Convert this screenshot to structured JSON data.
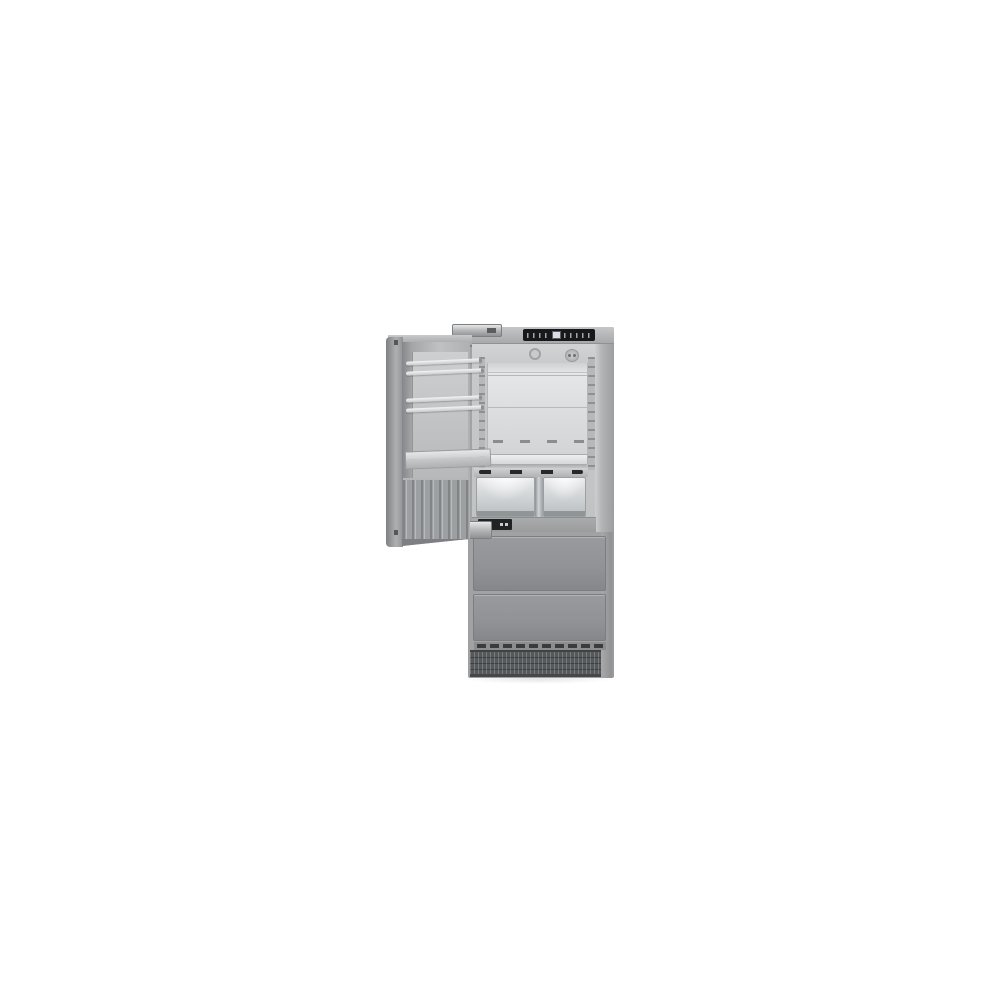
{
  "meta": {
    "description": "Product photograph of a tall built-in fridge-freezer combination centered on a plain white background. The refrigerator door is open to the left, revealing the interior; two freezer drawers and a ventilation grille form the lower half.",
    "background_color": "#ffffff",
    "visible_text": "none (control panel glyphs too small to read)"
  },
  "appliance": {
    "type": "built-in fridge-freezer combination",
    "state": "refrigerator door open to the left",
    "finish": "stainless steel / gray",
    "counts": {
      "door_racks": 2,
      "door_shelves": 1,
      "interior_shelf_lines": 3,
      "crisper_drawers": 2,
      "freezer_drawers": 2
    }
  },
  "components": {
    "cabinet": "stainless steel cabinet body",
    "cabinet_top": "cabinet top frame",
    "control_panel": "black touch control panel with small temperature display",
    "control_display": "illuminated temperature display",
    "interior": "refrigerator interior compartment",
    "brand_badge": "round brand badge on interior ceiling",
    "fan_vent": "interior fan / air vent",
    "back_panel": "stainless back wall with shelf levels",
    "rail_left": "left shelf support rail with slots",
    "rail_right": "right shelf support rail with slots",
    "crisper_rail": "glass shelf rail with black mounting clips",
    "crisper_left": "left transparent crisper drawer",
    "crisper_right": "right transparent crisper drawer",
    "crisper_divider": "steel divider between crisper drawers",
    "biofresh_display": "small black zone display below crisper drawers",
    "door": "open refrigerator door",
    "door_edge": "door outer panel seen edge-on",
    "door_rack_upper": "upper door storage rack (gallery rails)",
    "door_rack_lower": "lower door storage rack (gallery rails)",
    "door_shelf": "deep door shelf",
    "door_ribs": "ribbed lower inner door panel",
    "hinge_top": "top door hinge hardware",
    "hinge_bottom": "bottom door hinge hardware",
    "freezer_drawer_top": "upper freezer drawer front",
    "freezer_drawer_bottom": "lower freezer drawer front",
    "slot_row": "slotted trim row above base grille",
    "vent_grille": "base ventilation grille"
  },
  "colors": {
    "cabinet_gray": "#b2b4b6",
    "cabinet_shadow": "#97999b",
    "panel_black": "#16181a",
    "display_light": "#d8dee3",
    "interior_light": "#d9dbdd",
    "back_panel_steel": "#e0e2e4",
    "crisper_glass": "#dcdfe1",
    "freezer_drawer_gray": "#8f9194",
    "grille_dark": "#56595b",
    "hinge_metal": "#c8cacc"
  }
}
